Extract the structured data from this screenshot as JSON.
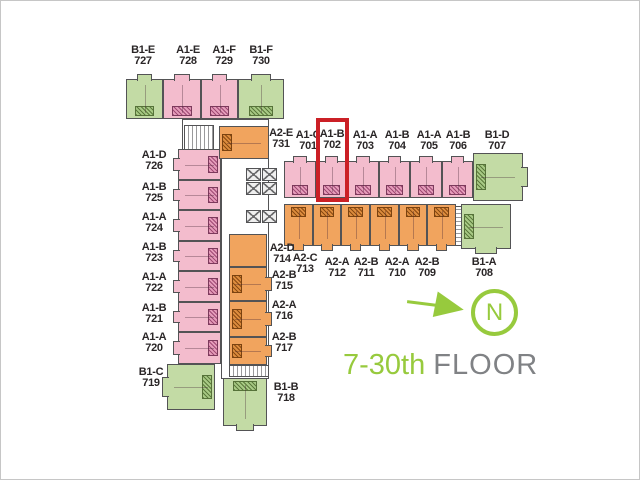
{
  "colors": {
    "pink": "#f3bccd",
    "orange": "#f1a45e",
    "green": "#c3dba5",
    "wall": "#535355",
    "label": "#2a2627",
    "accent": "#97ca3d",
    "graytext": "#808285",
    "highlight": "#cb2026"
  },
  "caption": {
    "range": "7-30th",
    "floor_word": "FLOOR"
  },
  "compass": {
    "letter": "N"
  },
  "highlight": {
    "unit_type": "A1-B",
    "unit_no": "702",
    "rect": [
      315,
      117,
      33,
      84
    ]
  },
  "units": [
    {
      "t": "B1-E",
      "n": "727",
      "c": "green",
      "r": [
        125,
        78,
        37,
        40
      ],
      "l": [
        142,
        44
      ],
      "h": "b",
      "b": "t"
    },
    {
      "t": "A1-E",
      "n": "728",
      "c": "pink",
      "r": [
        162,
        78,
        38,
        40
      ],
      "l": [
        187,
        44
      ],
      "h": "b",
      "b": "t"
    },
    {
      "t": "A1-F",
      "n": "729",
      "c": "pink",
      "r": [
        200,
        78,
        37,
        40
      ],
      "l": [
        223,
        44
      ],
      "h": "b",
      "b": "t"
    },
    {
      "t": "B1-F",
      "n": "730",
      "c": "green",
      "r": [
        237,
        78,
        46,
        40
      ],
      "l": [
        260,
        44
      ],
      "h": "b",
      "b": "t"
    },
    {
      "t": "A1-D",
      "n": "726",
      "c": "pink",
      "r": [
        177,
        148,
        43,
        31
      ],
      "l": [
        153,
        149
      ],
      "h": "r",
      "b": "l"
    },
    {
      "t": "A1-B",
      "n": "725",
      "c": "pink",
      "r": [
        177,
        179,
        43,
        30
      ],
      "l": [
        153,
        181
      ],
      "h": "r",
      "b": "l"
    },
    {
      "t": "A1-A",
      "n": "724",
      "c": "pink",
      "r": [
        177,
        209,
        43,
        31
      ],
      "l": [
        153,
        211
      ],
      "h": "r",
      "b": "l"
    },
    {
      "t": "A1-B",
      "n": "723",
      "c": "pink",
      "r": [
        177,
        240,
        43,
        30
      ],
      "l": [
        153,
        241
      ],
      "h": "r",
      "b": "l"
    },
    {
      "t": "A1-A",
      "n": "722",
      "c": "pink",
      "r": [
        177,
        270,
        43,
        31
      ],
      "l": [
        153,
        271
      ],
      "h": "r",
      "b": "l"
    },
    {
      "t": "A1-B",
      "n": "721",
      "c": "pink",
      "r": [
        177,
        301,
        43,
        30
      ],
      "l": [
        153,
        302
      ],
      "h": "r",
      "b": "l"
    },
    {
      "t": "A1-A",
      "n": "720",
      "c": "pink",
      "r": [
        177,
        331,
        43,
        32
      ],
      "l": [
        153,
        331
      ],
      "h": "r",
      "b": "l"
    },
    {
      "t": "B1-C",
      "n": "719",
      "c": "green",
      "r": [
        166,
        363,
        48,
        46
      ],
      "l": [
        150,
        366
      ],
      "h": "r",
      "b": "l"
    },
    {
      "t": "A2-E",
      "n": "731",
      "c": "orange",
      "r": [
        218,
        125,
        50,
        33
      ],
      "l": [
        280,
        127
      ],
      "h": "l",
      "b": ""
    },
    {
      "t": "A2-B",
      "n": "715",
      "c": "orange",
      "r": [
        228,
        266,
        38,
        34
      ],
      "l": [
        283,
        269
      ],
      "h": "l",
      "b": "r"
    },
    {
      "t": "A2-A",
      "n": "716",
      "c": "orange",
      "r": [
        228,
        300,
        38,
        36
      ],
      "l": [
        283,
        299
      ],
      "h": "l",
      "b": "r"
    },
    {
      "t": "A2-B",
      "n": "717",
      "c": "orange",
      "r": [
        228,
        336,
        38,
        28
      ],
      "l": [
        283,
        331
      ],
      "h": "l",
      "b": "r"
    },
    {
      "t": "B1-B",
      "n": "718",
      "c": "green",
      "r": [
        222,
        377,
        44,
        48
      ],
      "l": [
        285,
        381
      ],
      "h": "t",
      "b": "b"
    },
    {
      "t": "A1-C",
      "n": "701",
      "c": "pink",
      "r": [
        283,
        160,
        32,
        37
      ],
      "l": [
        307,
        129
      ],
      "h": "b",
      "b": "t"
    },
    {
      "t": "A1-B",
      "n": "702",
      "c": "pink",
      "r": [
        315,
        160,
        31,
        37
      ],
      "l": [
        331,
        128
      ],
      "h": "b",
      "b": "t"
    },
    {
      "t": "A1-A",
      "n": "703",
      "c": "pink",
      "r": [
        346,
        160,
        32,
        37
      ],
      "l": [
        364,
        129
      ],
      "h": "b",
      "b": "t"
    },
    {
      "t": "A1-B",
      "n": "704",
      "c": "pink",
      "r": [
        378,
        160,
        31,
        37
      ],
      "l": [
        396,
        129
      ],
      "h": "b",
      "b": "t"
    },
    {
      "t": "A1-A",
      "n": "705",
      "c": "pink",
      "r": [
        409,
        160,
        32,
        37
      ],
      "l": [
        428,
        129
      ],
      "h": "b",
      "b": "t"
    },
    {
      "t": "A1-B",
      "n": "706",
      "c": "pink",
      "r": [
        441,
        160,
        31,
        37
      ],
      "l": [
        457,
        129
      ],
      "h": "b",
      "b": "t"
    },
    {
      "t": "B1-D",
      "n": "707",
      "c": "green",
      "r": [
        472,
        152,
        50,
        48
      ],
      "l": [
        496,
        129
      ],
      "h": "l",
      "b": "r"
    },
    {
      "t": "A2-D",
      "n": "714",
      "c": "orange",
      "r": [
        283,
        203,
        29,
        42
      ],
      "l": [
        281,
        242
      ],
      "h": "t",
      "b": "b"
    },
    {
      "t": "A2-C",
      "n": "713",
      "c": "orange",
      "r": [
        312,
        203,
        28,
        42
      ],
      "l": [
        304,
        252
      ],
      "h": "t",
      "b": "b"
    },
    {
      "t": "A2-A",
      "n": "712",
      "c": "orange",
      "r": [
        340,
        203,
        29,
        42
      ],
      "l": [
        336,
        256
      ],
      "h": "t",
      "b": "b"
    },
    {
      "t": "A2-B",
      "n": "711",
      "c": "orange",
      "r": [
        369,
        203,
        29,
        42
      ],
      "l": [
        365,
        256
      ],
      "h": "t",
      "b": "b"
    },
    {
      "t": "A2-A",
      "n": "710",
      "c": "orange",
      "r": [
        398,
        203,
        28,
        42
      ],
      "l": [
        396,
        256
      ],
      "h": "t",
      "b": "b"
    },
    {
      "t": "A2-B",
      "n": "709",
      "c": "orange",
      "r": [
        426,
        203,
        29,
        42
      ],
      "l": [
        426,
        256
      ],
      "h": "t",
      "b": "b"
    },
    {
      "t": "B1-A",
      "n": "708",
      "c": "green",
      "r": [
        460,
        203,
        50,
        45
      ],
      "l": [
        483,
        256
      ],
      "h": "l",
      "b": "b"
    }
  ]
}
